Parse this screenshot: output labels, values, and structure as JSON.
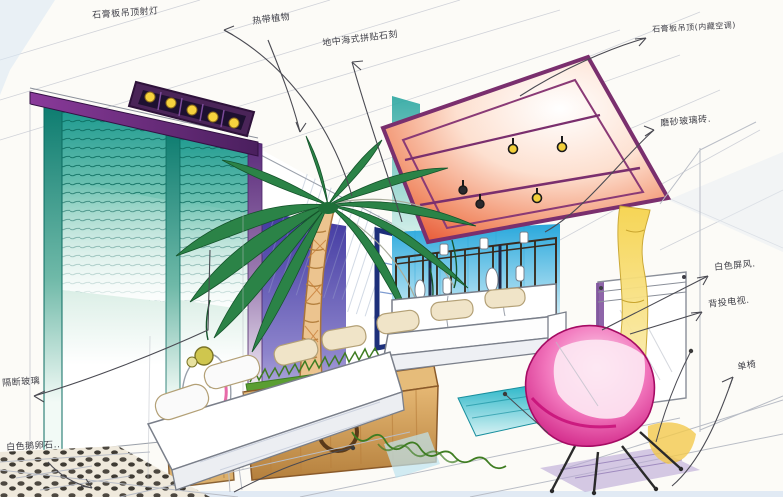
{
  "drawing_title": "手绘客厅室内效果图",
  "annotations": [
    {
      "id": "ceiling-spotlight-box",
      "text": "石膏板吊顶射灯"
    },
    {
      "id": "tropical-plant",
      "text": "热带植物"
    },
    {
      "id": "mediterranean-mosaic",
      "text": "地中海式拼贴石刻"
    },
    {
      "id": "gypsum-ceiling-concealed-ac",
      "text": "石膏板吊顶(内藏空调)"
    },
    {
      "id": "frosted-glass-brick",
      "text": "磨砂玻璃砖."
    },
    {
      "id": "white-screen",
      "text": "白色屏风."
    },
    {
      "id": "rear-projection-tv",
      "text": "背投电视."
    },
    {
      "id": "single-chair",
      "text": "单椅"
    },
    {
      "id": "partition-glass",
      "text": "隔断玻璃"
    },
    {
      "id": "white-pebbles",
      "text": "白色鹅卵石.."
    }
  ],
  "palette": {
    "paper": "#fcfbf7",
    "pencil": "#b9bdc6",
    "ink": "#3e3e46",
    "glass_teal": "#16968c",
    "beam_purple": "#6e2a84",
    "panel_red": "#e3401f",
    "panel_frame_purple": "#7a2f6e",
    "wall_indigo": "#4038a0",
    "wall_blue": "#29a8dc",
    "navy": "#1d2f7a",
    "palm_green": "#2b8347",
    "trunk_tan": "#ecc48f",
    "planter_wood": "#d8a35c",
    "grass_green": "#5a9e32",
    "pillow_cream": "#f0e4c8",
    "chair_magenta": "#d6007f",
    "curtain_yellow": "#f6d44d",
    "shadow_purple": "#b9a6d6",
    "pebble_dark": "#4d4840"
  }
}
